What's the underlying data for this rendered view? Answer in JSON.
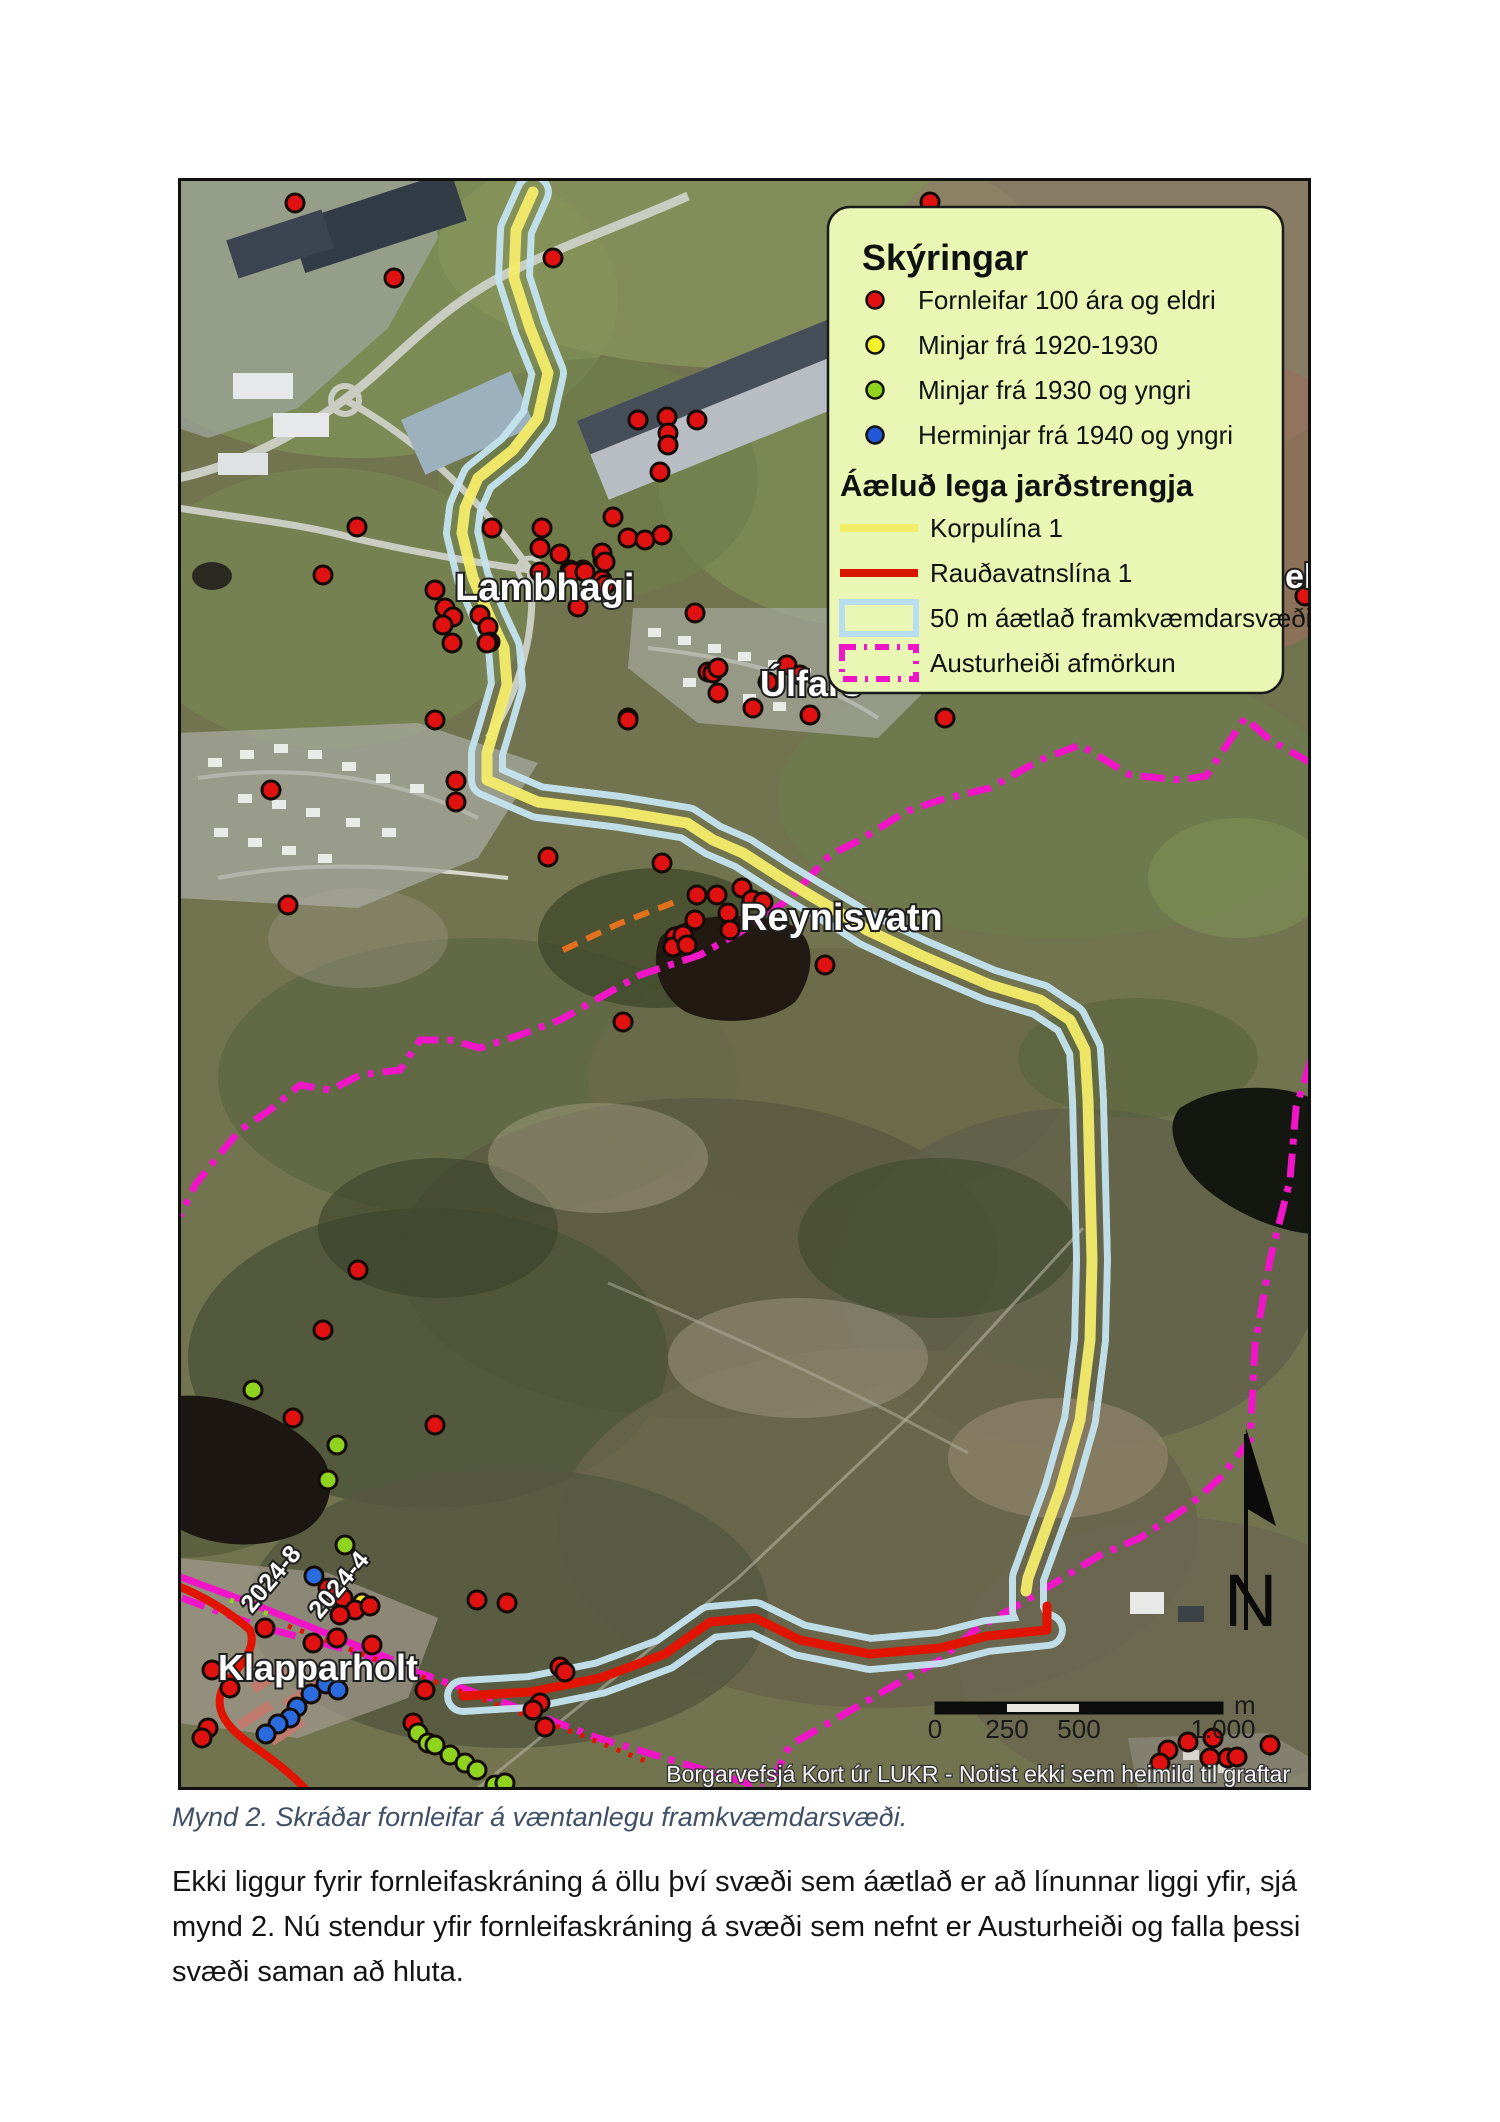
{
  "map": {
    "labels": [
      {
        "text": "Lambhagi",
        "x": 277,
        "y": 422,
        "size": 38,
        "rotate": 0
      },
      {
        "text": "Úlfars",
        "x": 582,
        "y": 518,
        "size": 36,
        "rotate": 0
      },
      {
        "text": "Reynisvatn",
        "x": 562,
        "y": 752,
        "size": 38,
        "rotate": 0
      },
      {
        "text": "ell",
        "x": 1107,
        "y": 410,
        "size": 34,
        "rotate": 0
      },
      {
        "text": "Klapparholt",
        "x": 40,
        "y": 1502,
        "size": 36,
        "rotate": 0
      },
      {
        "text": "2024-8",
        "x": 74,
        "y": 1436,
        "size": 25,
        "rotate": -50
      },
      {
        "text": "2024-4",
        "x": 142,
        "y": 1442,
        "size": 25,
        "rotate": -50
      }
    ],
    "legend": {
      "title": "Skýringar",
      "subtitle": "Áæluð lega jarðstrengja",
      "background": "#e9f6b4",
      "point_items": [
        {
          "color": "#e01111",
          "label": "Fornleifar 100 ára og eldri"
        },
        {
          "color": "#f6ef2b",
          "label": "Minjar frá 1920-1930"
        },
        {
          "color": "#8fd31f",
          "label": "Minjar frá 1930 og yngri"
        },
        {
          "color": "#2257d6",
          "label": "Herminjar frá 1940 og yngri"
        }
      ],
      "line_items": [
        {
          "kind": "line",
          "color": "#f3ec6a",
          "label": "Korpulína 1"
        },
        {
          "kind": "line",
          "color": "#d81600",
          "label": "Rauðavatnslína 1"
        },
        {
          "kind": "rect",
          "color": "#b8ddf0",
          "label": "50 m áætlað framkvæmdarsvæði"
        },
        {
          "kind": "dashrect",
          "color": "#f016c8",
          "label": "Austurheiði afmörkun"
        }
      ]
    },
    "scalebar": {
      "ticks": [
        "0",
        "250",
        "500",
        "1.000"
      ],
      "unit": "m"
    },
    "north_label": "N",
    "attribution": "Borgarvefsjá Kort úr LUKR - Notist ekki sem heimild til graftar",
    "colors": {
      "corridor": "#c4e4f0",
      "korpulina": "#f3ec6a",
      "raudavatnslina": "#e01400",
      "austurheidi": "#f016c8",
      "orange_line": "#e2711d",
      "dot_red": "#e01111",
      "dot_green": "#8fd31f",
      "dot_blue": "#2a6be0",
      "dot_yellow": "#f8e926"
    },
    "routes": {
      "korpulina": "M355,14 L338,52 L336,100 L352,150 L370,195 L360,240 L335,272 L300,300 L287,330 L284,355 L295,400 L312,440 L326,470 L329,507 L318,545 L309,575 L309,602 L360,624 L442,634 L509,645 L535,662 L565,675 L602,699 L635,719 L669,739 L689,752 L742,777 L812,807 L862,822 L892,842 L907,872 L910,922 L912,1002 L914,1082 L912,1162 L902,1242 L882,1312 L862,1367 L850,1400 L848,1413",
      "raudavatnslina": "M869,1428 L869,1452 L809,1458 L762,1470 L692,1476 L622,1462 L577,1440 L532,1444 L487,1476 L422,1500 L352,1514 L285,1518",
      "corridor": "M355,14 L338,52 L336,100 L352,150 L370,195 L360,240 L335,272 L300,300 L287,330 L284,355 L295,400 L312,440 L326,470 L329,507 L318,545 L309,575 L309,602 L360,624 L442,634 L509,645 L535,662 L565,675 L602,699 L635,719 L669,739 L689,752 L742,777 L812,807 L862,822 L892,842 L907,872 L910,922 L912,1002 L914,1082 L912,1162 L902,1242 L882,1312 L862,1367 L850,1400 L850,1432 L856,1446 L869,1452 L809,1458 L762,1470 L692,1476 L622,1462 L577,1440 L532,1444 L487,1476 L422,1500 L352,1514 L285,1518",
      "austurheidi_north": "M1133,585 L1092,562 L1067,540 L1028,598 L1002,602 L952,597 L902,567 L862,582 L812,610 L762,622 L727,634 L682,662 L652,677 L612,720 L582,742 L557,757 L522,777 L462,797 L382,842 L342,857 L302,870 L272,862 L242,862 L222,892 L182,897 L152,912 L122,907 L92,932 L62,952 L37,982 L17,1007 L2,1038",
      "austurheidi_south": "M1133,882 L1118,930 L1112,1002 L1092,1082 L1077,1167 L1072,1262 L1042,1300 L1012,1327 L962,1360 L922,1377 L857,1417 L797,1452 L762,1482 L722,1504 L682,1527 L642,1550 L612,1567 L597,1597 L590,1612",
      "austurheidi_sw": "M4,1420 L80,1448 L170,1472 L250,1498 L330,1526 L420,1560 L480,1578 L540,1596 L585,1610",
      "magenta_solid": "M0,1398 L70,1424 L150,1456 L215,1482",
      "orange": "M385,772 L440,746 L502,722",
      "red_west": "M0,1408 C20,1416 50,1432 72,1452 C80,1472 60,1488 44,1512 C36,1532 48,1550 78,1570 C98,1584 116,1598 128,1612",
      "red_dotted": "M110,1448 L200,1482 L300,1520 L400,1556 L470,1584",
      "green_dotted": "M52,1422 L96,1438"
    },
    "markers": {
      "red": [
        [
          117,
          25
        ],
        [
          375,
          80
        ],
        [
          216,
          100
        ],
        [
          752,
          24
        ],
        [
          460,
          242
        ],
        [
          489,
          239
        ],
        [
          519,
          242
        ],
        [
          490,
          255
        ],
        [
          490,
          267
        ],
        [
          482,
          294
        ],
        [
          435,
          339
        ],
        [
          314,
          350
        ],
        [
          364,
          350
        ],
        [
          450,
          360
        ],
        [
          467,
          362
        ],
        [
          484,
          357
        ],
        [
          382,
          376
        ],
        [
          425,
          382
        ],
        [
          392,
          392
        ],
        [
          405,
          392
        ],
        [
          179,
          349
        ],
        [
          145,
          397
        ],
        [
          362,
          370
        ],
        [
          257,
          412
        ],
        [
          267,
          430
        ],
        [
          275,
          439
        ],
        [
          265,
          447
        ],
        [
          302,
          437
        ],
        [
          310,
          449
        ],
        [
          312,
          464
        ],
        [
          274,
          465
        ],
        [
          309,
          465
        ],
        [
          257,
          542
        ],
        [
          424,
          375
        ],
        [
          427,
          384
        ],
        [
          394,
          394
        ],
        [
          407,
          394
        ],
        [
          424,
          402
        ],
        [
          427,
          407
        ],
        [
          362,
          394
        ],
        [
          400,
          429
        ],
        [
          517,
          435
        ],
        [
          530,
          494
        ],
        [
          450,
          540
        ],
        [
          535,
          495
        ],
        [
          540,
          490
        ],
        [
          609,
          487
        ],
        [
          622,
          497
        ],
        [
          590,
          504
        ],
        [
          540,
          515
        ],
        [
          632,
          537
        ],
        [
          450,
          542
        ],
        [
          575,
          530
        ],
        [
          93,
          612
        ],
        [
          278,
          603
        ],
        [
          278,
          624
        ],
        [
          110,
          727
        ],
        [
          370,
          679
        ],
        [
          484,
          685
        ],
        [
          519,
          717
        ],
        [
          539,
          717
        ],
        [
          517,
          742
        ],
        [
          550,
          735
        ],
        [
          552,
          752
        ],
        [
          497,
          759
        ],
        [
          495,
          769
        ],
        [
          564,
          710
        ],
        [
          574,
          722
        ],
        [
          585,
          724
        ],
        [
          647,
          787
        ],
        [
          445,
          844
        ],
        [
          505,
          757
        ],
        [
          509,
          767
        ],
        [
          767,
          540
        ],
        [
          804,
          369
        ],
        [
          1127,
          418
        ],
        [
          180,
          1092
        ],
        [
          145,
          1152
        ],
        [
          115,
          1240
        ],
        [
          257,
          1247
        ],
        [
          87,
          1450
        ],
        [
          135,
          1465
        ],
        [
          159,
          1460
        ],
        [
          194,
          1467
        ],
        [
          247,
          1512
        ],
        [
          235,
          1545
        ],
        [
          30,
          1550
        ],
        [
          24,
          1560
        ],
        [
          52,
          1510
        ],
        [
          34,
          1492
        ],
        [
          299,
          1422
        ],
        [
          329,
          1425
        ],
        [
          382,
          1489
        ],
        [
          387,
          1494
        ],
        [
          362,
          1525
        ],
        [
          367,
          1549
        ],
        [
          355,
          1532
        ],
        [
          150,
          1410
        ],
        [
          165,
          1420
        ],
        [
          177,
          1432
        ],
        [
          192,
          1428
        ],
        [
          162,
          1437
        ],
        [
          990,
          1572
        ],
        [
          1010,
          1564
        ],
        [
          1032,
          1580
        ],
        [
          1050,
          1580
        ],
        [
          1059,
          1579
        ],
        [
          1092,
          1567
        ],
        [
          982,
          1585
        ],
        [
          1035,
          1560
        ]
      ],
      "green": [
        [
          240,
          1555
        ],
        [
          250,
          1565
        ],
        [
          257,
          1567
        ],
        [
          272,
          1577
        ],
        [
          287,
          1585
        ],
        [
          299,
          1592
        ],
        [
          317,
          1607
        ],
        [
          327,
          1605
        ],
        [
          159,
          1267
        ],
        [
          150,
          1302
        ],
        [
          167,
          1367
        ],
        [
          75,
          1212
        ]
      ],
      "blue": [
        [
          136,
          1398
        ],
        [
          148,
          1506
        ],
        [
          160,
          1512
        ],
        [
          133,
          1516
        ],
        [
          119,
          1529
        ],
        [
          112,
          1540
        ],
        [
          100,
          1546
        ],
        [
          88,
          1556
        ]
      ],
      "yellow": [
        [
          184,
          1424
        ]
      ]
    }
  },
  "caption": "Mynd 2. Skráðar fornleifar á væntanlegu framkvæmdarsvæði.",
  "paragraph": "Ekki liggur fyrir fornleifaskráning á öllu því svæði sem áætlað er að línunnar liggi yfir, sjá mynd 2. Nú stendur yfir fornleifaskráning á svæði sem nefnt er Austurheiði og falla þessi svæði saman að hluta."
}
